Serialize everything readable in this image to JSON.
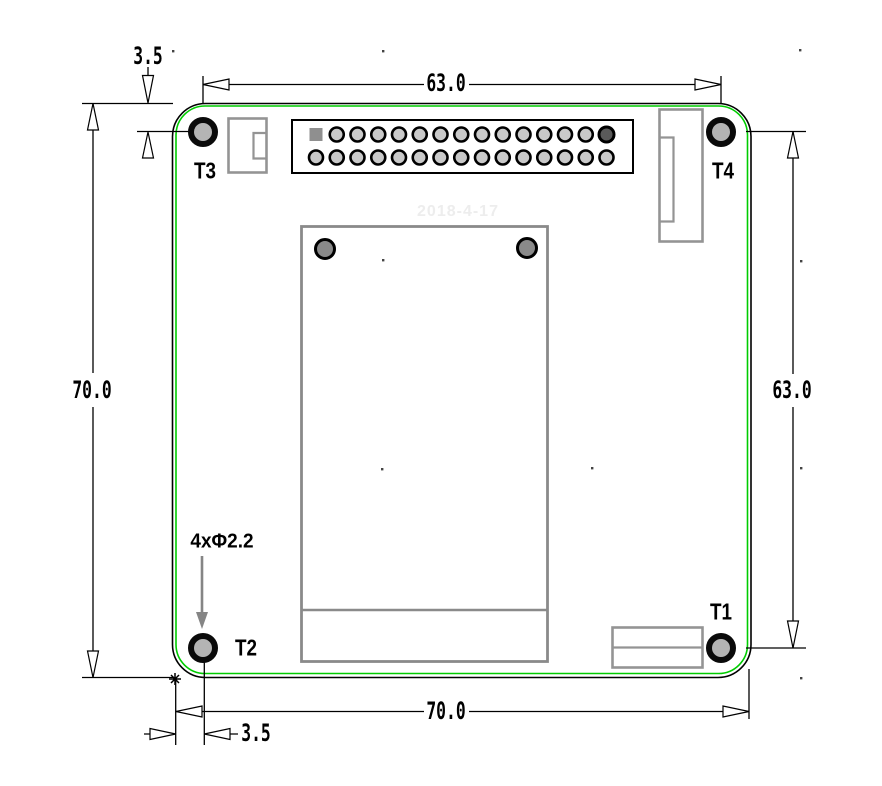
{
  "drawing": {
    "watermark": "2018-4-17",
    "labels": {
      "t1": "T1",
      "t2": "T2",
      "t3": "T3",
      "t4": "T4"
    },
    "dimensions": {
      "hole_span_width": "63.0",
      "hole_span_height": "63.0",
      "board_height": "70.0",
      "board_width": "70.0",
      "hole_offset_top": "3.5",
      "hole_offset_left": "3.5",
      "hole_callout": "4xΦ2.2"
    },
    "pin_header": {
      "rows": 2,
      "columns": 15,
      "pin1_square": true
    },
    "colors": {
      "board_outline": "#00cc00",
      "hole_fill": "#b4b4b4",
      "pin_fill": "#c9c9c9",
      "dark_pin_fill": "#5a5a5a",
      "connector_outline": "#949494",
      "callout_arrow": "#858585"
    },
    "reference_dots": [
      [
        173,
        51
      ],
      [
        383,
        51
      ],
      [
        800,
        50
      ],
      [
        383,
        260
      ],
      [
        801,
        261
      ],
      [
        382,
        469
      ],
      [
        592,
        468
      ],
      [
        801,
        468
      ],
      [
        801,
        678
      ]
    ]
  }
}
